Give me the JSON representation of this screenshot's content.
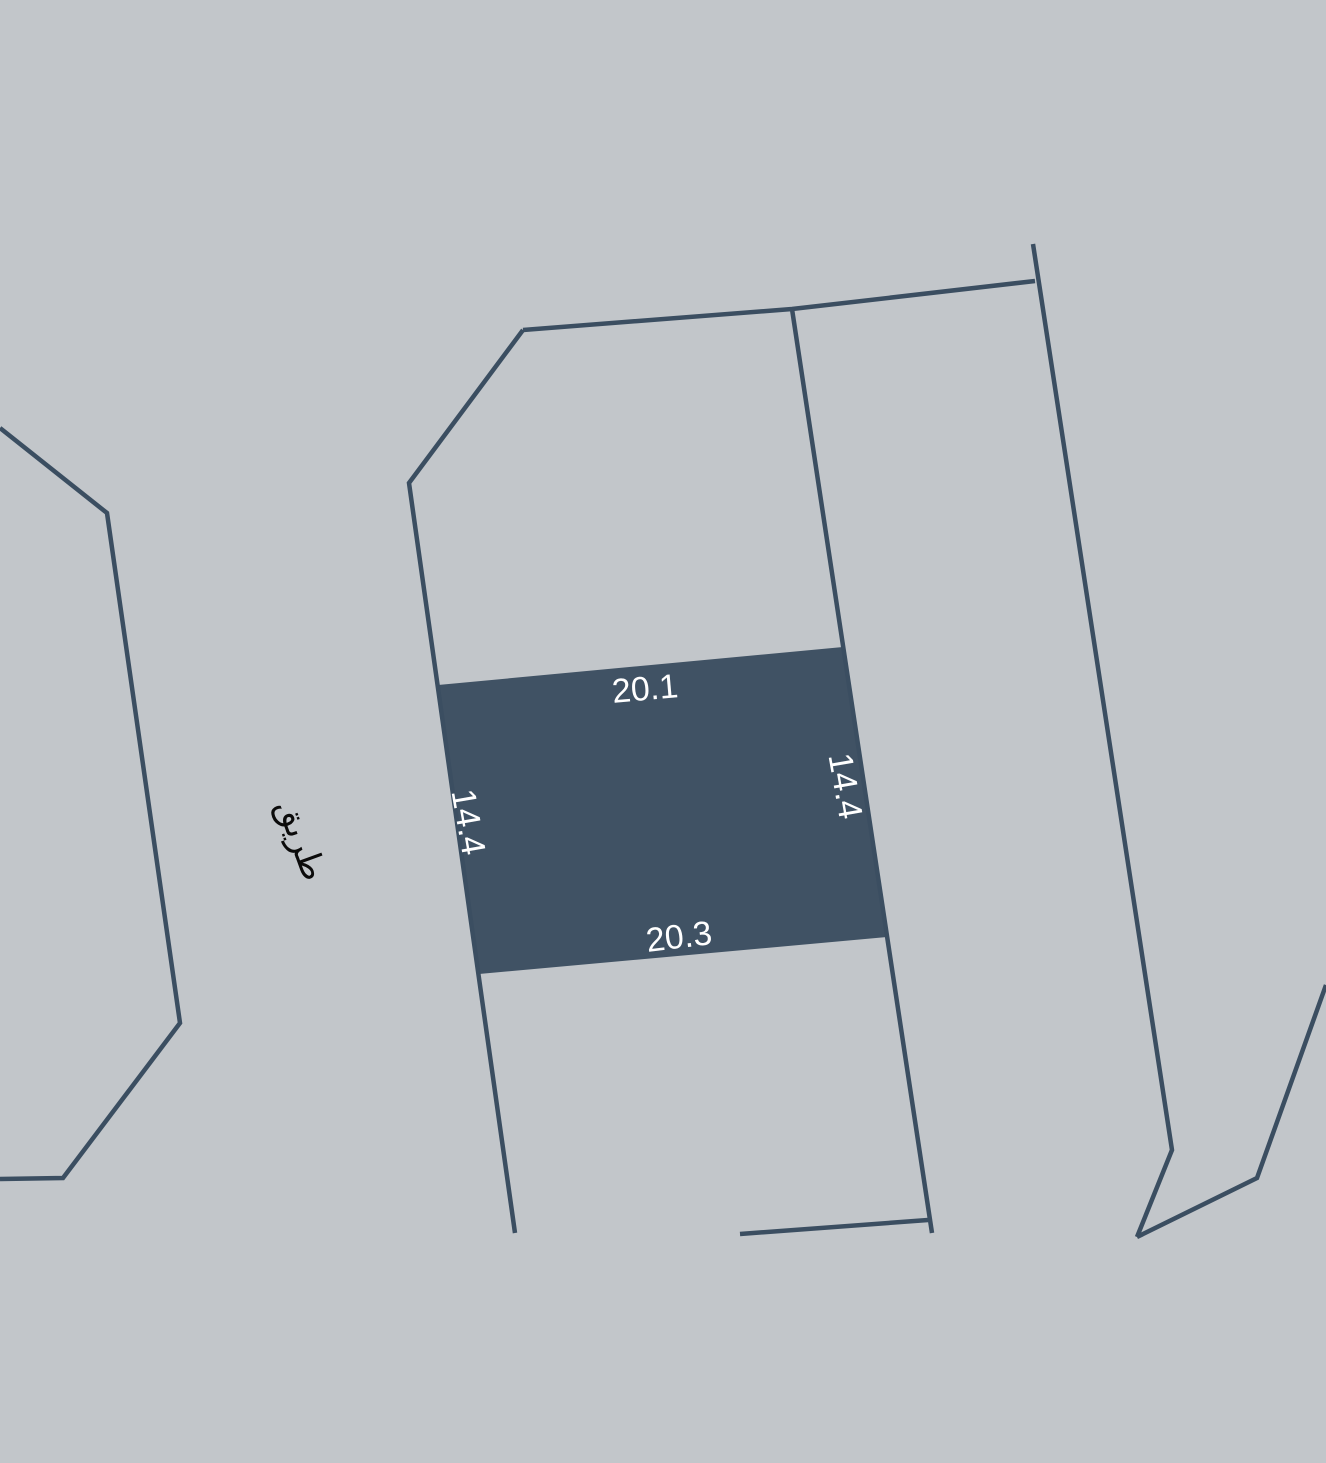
{
  "map": {
    "background_color": "#c2c6ca",
    "boundary_color": "#3b4e61",
    "boundary_stroke_width": 4.5,
    "canvas": {
      "width": 1326,
      "height": 1463
    },
    "boundaries": [
      {
        "name": "left-parcel-boundary",
        "points": "0,428 107,513 180,1023 63,1178 0,1179"
      },
      {
        "name": "west-block-boundary",
        "points": "523,330 409,483 515,1233"
      },
      {
        "name": "north-block-boundary",
        "points": "523,330 792,309 1035,281"
      },
      {
        "name": "middle-block-boundary",
        "points": "792,309 932,1233"
      },
      {
        "name": "east-block-boundary",
        "points": "1033,244 1172,1150 1137,1237"
      },
      {
        "name": "southeast-boundary",
        "points": "1326,985 1257,1178 1137,1237"
      },
      {
        "name": "south-block-boundary",
        "points": "740,1234 928,1220"
      }
    ],
    "selected_parcel": {
      "fill_color": "#405264",
      "points": "438,685 843,647 887,937 479,974",
      "dimensions": {
        "top": "20.1",
        "bottom": "20.3",
        "left": "14.4",
        "right": "14.4"
      }
    },
    "labels": [
      {
        "id": "dimension-top",
        "text": "20.1",
        "x": 645,
        "y": 689,
        "rotate": -5,
        "size": 34,
        "color": "#ffffff"
      },
      {
        "id": "dimension-bottom",
        "text": "20.3",
        "x": 679,
        "y": 937,
        "rotate": -7,
        "size": 34,
        "color": "#ffffff"
      },
      {
        "id": "dimension-left",
        "text": "14.4",
        "x": 468,
        "y": 822,
        "rotate": 80,
        "size": 34,
        "color": "#ffffff"
      },
      {
        "id": "dimension-right",
        "text": "14.4",
        "x": 845,
        "y": 786,
        "rotate": 80,
        "size": 34,
        "color": "#ffffff"
      },
      {
        "id": "road-label",
        "text": "طريق",
        "x": 301,
        "y": 840,
        "rotate": 70,
        "size": 34,
        "color": "#0b0b0b"
      }
    ]
  }
}
